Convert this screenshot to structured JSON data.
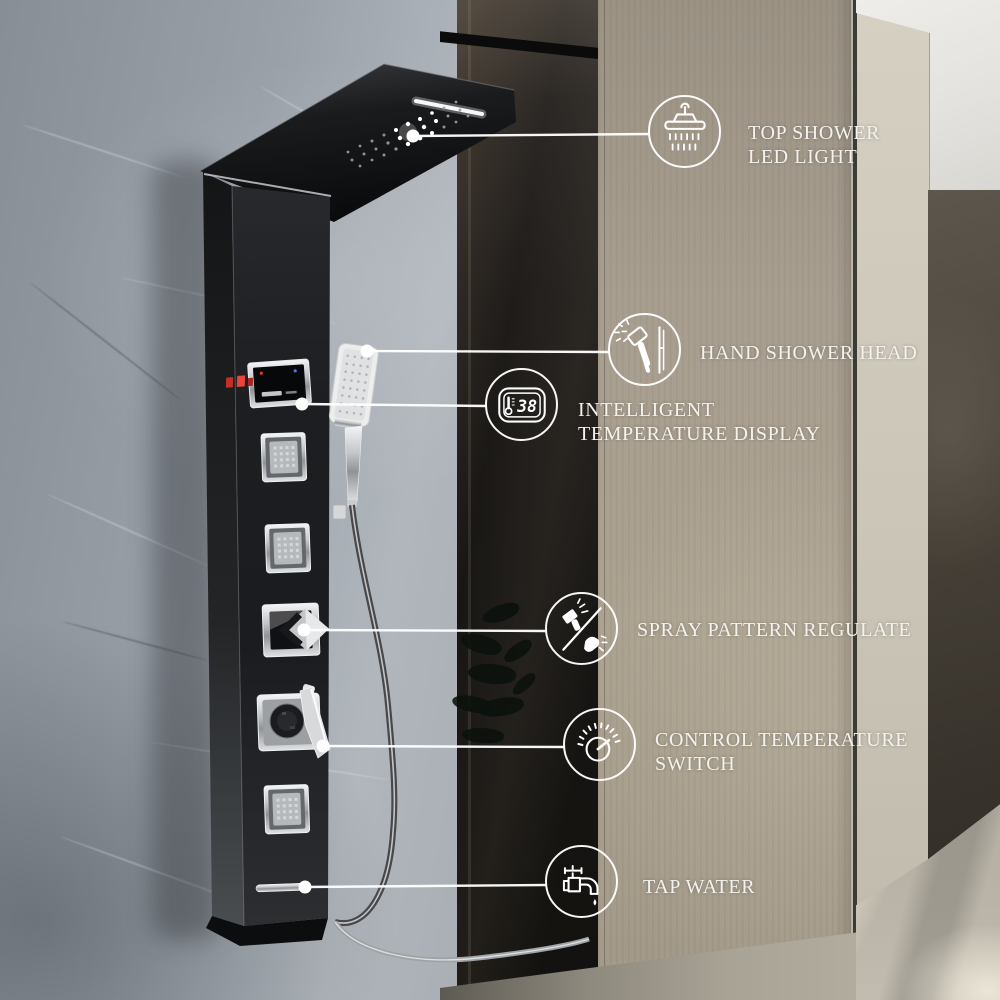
{
  "scene": {
    "description_elements": [
      "marble-wall",
      "shower-glass",
      "wood-wall",
      "hallway",
      "black-shower-panel"
    ]
  },
  "callouts": {
    "top_shower": {
      "line1": "TOP SHOWER",
      "line2": "LED LIGHT",
      "icon": "top-shower-led-icon"
    },
    "hand_shower": {
      "line1": "HAND SHOWER HEAD",
      "icon": "hand-shower-icon"
    },
    "temperature_display": {
      "line1": "INTELLIGENT",
      "line2": "TEMPERATURE DISPLAY",
      "icon": "temperature-display-icon",
      "display_value": "38"
    },
    "spray_pattern": {
      "line1": "SPRAY PATTERN REGULATE",
      "icon": "spray-pattern-icon"
    },
    "control_temperature": {
      "line1": "CONTROL TEMPERATURE",
      "line2": "SWITCH",
      "icon": "temperature-dial-icon"
    },
    "tap_water": {
      "line1": "TAP WATER",
      "icon": "tap-water-icon"
    }
  },
  "colors": {
    "callout_line": "#ffffff",
    "label_text": "#f4f2ec",
    "panel_black": "#1d1f22",
    "chrome": "#d6d8da",
    "display_glow_red": "#e0392e",
    "display_dot_blue": "#4576f0",
    "wood_wall": "#a79d8e",
    "marble_wall": "#99a0a8",
    "dark_marble": "#3f3a33",
    "glass_tint": "#1b1917"
  }
}
